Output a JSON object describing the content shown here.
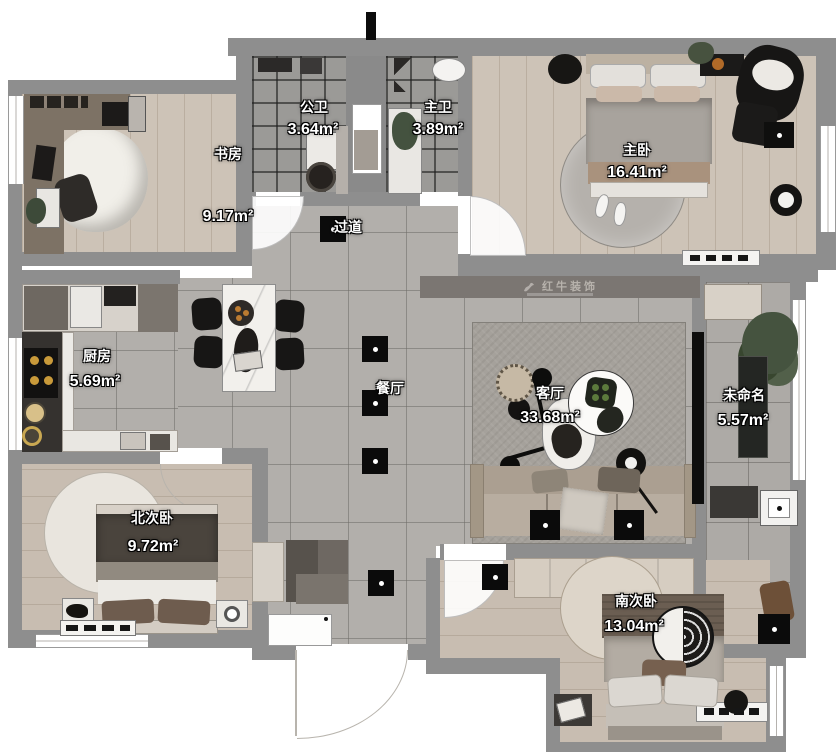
{
  "plan": {
    "watermark": {
      "brand": "红牛装饰"
    },
    "rooms": {
      "study": {
        "name": "书房",
        "area": "9.17m²"
      },
      "public_bath": {
        "name": "公卫",
        "area": "3.64m²"
      },
      "master_bath": {
        "name": "主卫",
        "area": "3.89m²"
      },
      "master_bedroom": {
        "name": "主卧",
        "area": "16.41m²"
      },
      "hallway": {
        "name": "过道",
        "area": ""
      },
      "kitchen": {
        "name": "厨房",
        "area": "5.69m²"
      },
      "dining": {
        "name": "餐厅",
        "area": ""
      },
      "living": {
        "name": "客厅",
        "area": "33.68m²"
      },
      "unnamed": {
        "name": "未命名",
        "area": "5.57m²"
      },
      "north_bedroom": {
        "name": "北次卧",
        "area": "9.72m²"
      },
      "south_bedroom": {
        "name": "南次卧",
        "area": "13.04m²"
      }
    },
    "colors": {
      "wall": "#8e8e8e",
      "accent": "#c77f2e"
    }
  }
}
